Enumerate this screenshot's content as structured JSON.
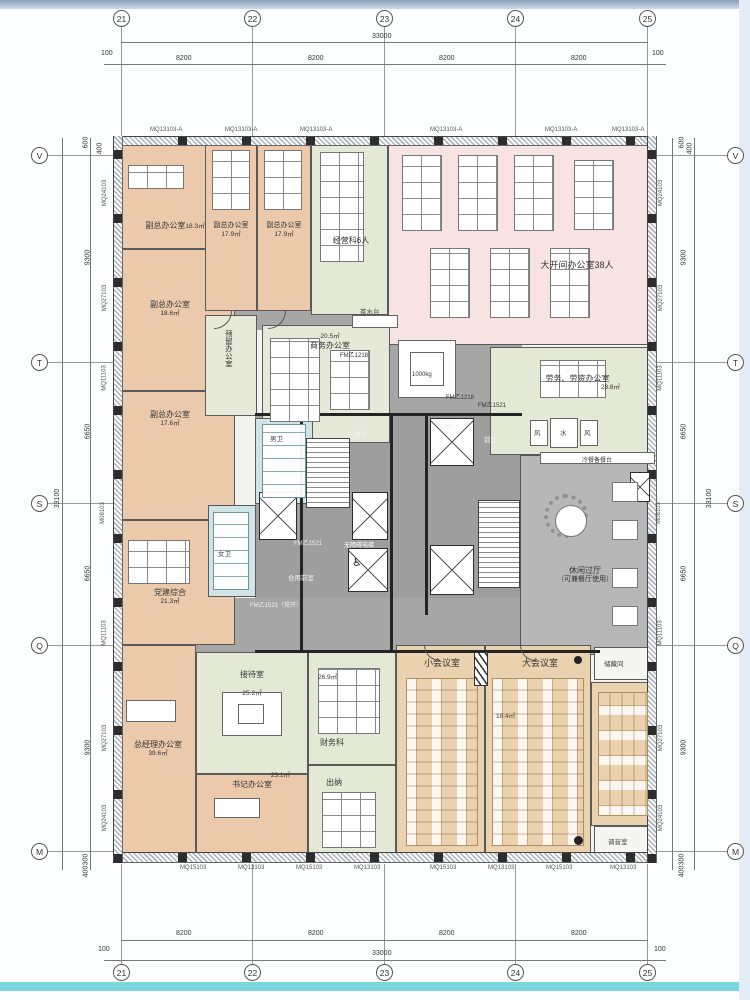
{
  "drawing": {
    "type": "office-floor-plan"
  },
  "grid": {
    "top_bubbles": [
      "21",
      "22",
      "23",
      "24",
      "25"
    ],
    "side_bubbles": [
      "V",
      "T",
      "S",
      "Q",
      "M"
    ],
    "top_total": "33000",
    "top_segments": [
      "8200",
      "8200",
      "8200",
      "8200"
    ],
    "top_end_offset": "100",
    "side_total": "33100",
    "side_segments": [
      "9300",
      "6650",
      "6650",
      "9300"
    ],
    "side_top_offsets": [
      "600",
      "400"
    ],
    "side_bottom_offsets": [
      "300",
      "400"
    ]
  },
  "facade": {
    "left": [
      "MQ24103",
      "MQ27103",
      "MQ11103",
      "M08103",
      "MQ11103",
      "MQ27103",
      "MQ24103"
    ],
    "right": [
      "MQ24103",
      "MQ27103",
      "MQ11103",
      "M08103",
      "MQ11103",
      "MQ27103",
      "MQ24103"
    ],
    "top": [
      "MQ13103-A",
      "MQ13103-A",
      "MQ13103-A",
      "MQ13103-A",
      "MQ13103-A",
      "MQ13103-A"
    ],
    "bottom": [
      "MQ15103",
      "MQ13103",
      "MQ15103",
      "MQ13103",
      "MQ15103",
      "MQ13103",
      "MQ15103",
      "MQ13103"
    ]
  },
  "rooms": {
    "vp1": {
      "name": "副总办公室",
      "area": "18.3㎡"
    },
    "vp2": {
      "name": "副总办公室",
      "area": "17.9㎡"
    },
    "vp3": {
      "name": "副总办公室",
      "area": "17.9㎡"
    },
    "ops": {
      "name": "经营科6人"
    },
    "open_office": {
      "name": "大开间办公室38人"
    },
    "vp4": {
      "name": "副总办公室",
      "area": "18.6㎡"
    },
    "reserved": {
      "name": "预留办公室"
    },
    "business": {
      "name": "商务办公室",
      "area": "20.5㎡"
    },
    "labor": {
      "name": "劳务、劳资办公室",
      "area": "28.8㎡"
    },
    "vp5": {
      "name": "副总办公室",
      "area": "17.6㎡"
    },
    "party": {
      "name": "党建综合",
      "area": "21.3㎡"
    },
    "lounge": {
      "name": "休闲过厅",
      "note": "（可兼餐厅使用）"
    },
    "gm": {
      "name": "总经理办公室",
      "area": "39.6㎡"
    },
    "reception": {
      "name": "接待室",
      "area": "25.2㎡"
    },
    "secretary": {
      "name": "书记办公室",
      "area": "23.1㎡"
    },
    "finance": {
      "name": "财务科",
      "area": "26.9㎡"
    },
    "cashier": {
      "name": "出纳"
    },
    "small_meeting": {
      "name": "小会议室"
    },
    "large_meeting": {
      "name": "大会议室",
      "area": "18.4㎡"
    },
    "storage": {
      "name": "储藏间"
    },
    "tuning": {
      "name": "调音室"
    },
    "wc_m": {
      "name": "男卫"
    },
    "wc_f": {
      "name": "女卫"
    }
  },
  "core": {
    "vestibule": "前室",
    "shared_vestibule": "合用前室",
    "weak_power": "弱电",
    "water": "水",
    "air": "风",
    "accessible_lift": "无障碍电梯",
    "tea_counter": "茶水台",
    "buffet_counter": "冷餐备餐台",
    "lift_capacity": "1000kg"
  },
  "doors": {
    "fm1521": "FM乙1521",
    "fm1521_open": "FM乙1521（常开）",
    "fm1218": "FM乙1218"
  },
  "colors": {
    "office_peach": "#ecc9ab",
    "open_office_pink": "#f7e4e2",
    "dept_green": "#e4e9d5",
    "meeting_tan": "#ead2ae",
    "wc_blue": "#cfe4e6",
    "corridor_gray": "#a6a6a6",
    "lounge_gray": "#b7b7b7"
  }
}
